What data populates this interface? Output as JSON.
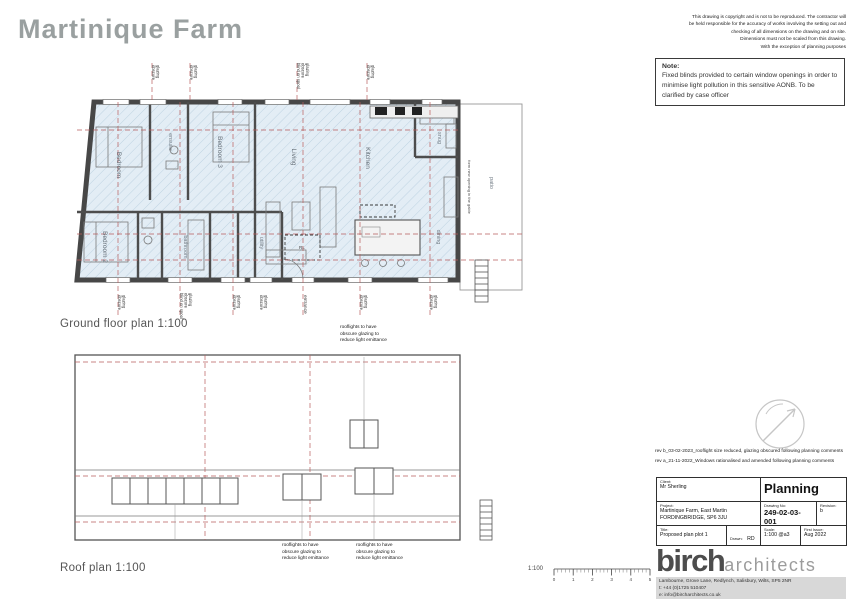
{
  "sheet": {
    "title": "Martinique Farm"
  },
  "copyright": {
    "lines": [
      "This drawing is copyright and is not to be reproduced. The contractor will",
      "be held responsible for the accuracy of works involving the setting out and",
      "checking of all dimensions on the drawing and on site.",
      "Dimensions must not be scaled from this drawing.",
      "With the exception of planning purposes"
    ]
  },
  "note": {
    "heading": "Note:",
    "body": "Fixed blinds provided to certain window openings in order to minimise light pollution in this sensitive AONB. To be clarified by case officer"
  },
  "ground_floor": {
    "caption": "Ground floor plan  1:100",
    "rooms": {
      "bedroom": "Bedroom",
      "ensuite": "ensuite",
      "bedroom3": "Bedroom 3",
      "living": "Living",
      "kitchen": "Kitchen",
      "snug": "snug",
      "bedroom2": "Bedroom 2",
      "bathroom": "bathroom",
      "utility": "utility",
      "dining": "dining",
      "patio": "patio"
    },
    "rooflight_tag": "RL",
    "window_label_lines": [
      "obscure",
      "glazing"
    ],
    "blind_label_lines": [
      "blind on spool",
      "obscure",
      "glazing"
    ],
    "entrance_label": "entrance",
    "opening_label": "form new opening in the gable"
  },
  "roof": {
    "caption": "Roof plan  1:100",
    "note_lines": [
      "rooflights to have",
      "obscure glazing to",
      "reduce light emittance"
    ]
  },
  "revisions": {
    "lines": [
      "rev b_03-02-2023_rooflight size reduced, glazing obscured following planning comments",
      "rev a_21-11-2022_Windows rationalised and amended following planning comments"
    ]
  },
  "titleblock": {
    "client_label": "Client:",
    "client": "Mr Sherling",
    "status": "Planning",
    "project_label": "Project:",
    "project_line1": "Martinique Farm, East Martin",
    "project_line2": "FORDINGBRIDGE, SP6 3JU",
    "drawing_no_label": "Drawing No:",
    "drawing_no": "249-02-03-001",
    "revision_label": "Revision:",
    "revision": "b",
    "title_label": "Title:",
    "title": "Proposed  plan plot 1",
    "drawn_label": "Drawn:",
    "drawn": "RD",
    "check_label": "Check:",
    "scale_label": "Scale:",
    "scale": "1:100 @a3",
    "first_issue_label": "First Issue:",
    "first_issue": "Aug 2022"
  },
  "firm": {
    "name_bold": "birch",
    "name_light": "architects",
    "address": "Lambourne, Grove Lane, Redlynch, Salisbury, Wilts, SP5 2NR",
    "phone": "t: +44 (0)1725 510407",
    "email": "e: info@bircharchitects.co.uk"
  },
  "scalebar": {
    "label": "1:100",
    "ticks": [
      "0",
      "1",
      "2",
      "3",
      "4",
      "5"
    ]
  }
}
